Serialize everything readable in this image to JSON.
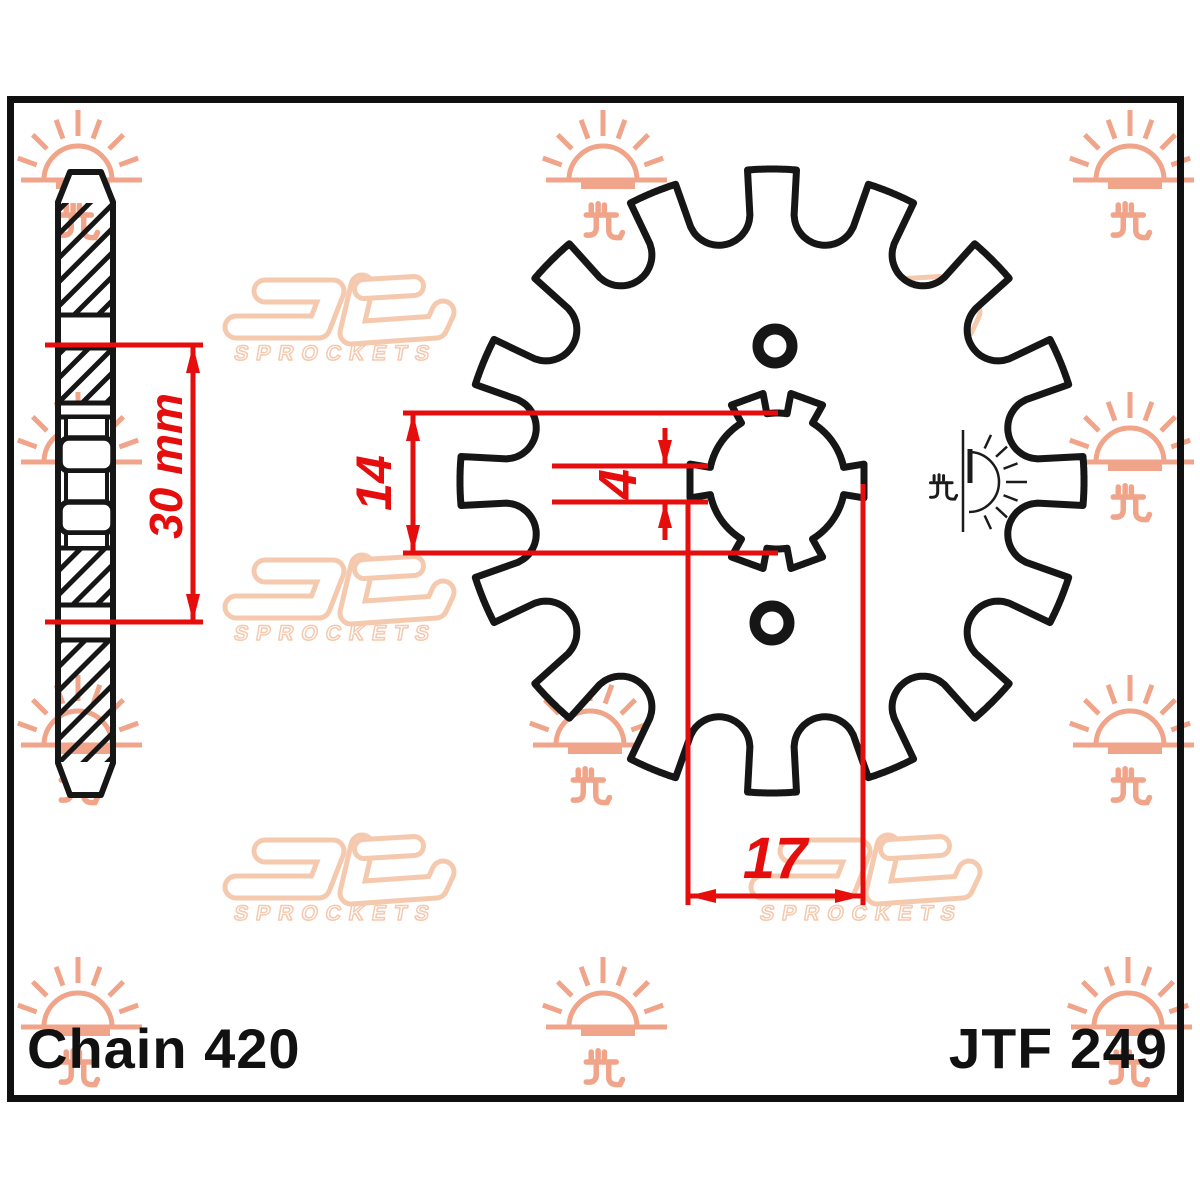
{
  "title": "JT Sprockets front sprocket technical drawing",
  "labels": {
    "chain": "Chain 420",
    "part_number": "JTF 249"
  },
  "dimensions": {
    "hub_width": "30 mm",
    "bore_height": "14",
    "groove_width": "4",
    "bore_width": "17"
  },
  "watermarks": {
    "logo_text": "SPROCKETS",
    "sun_positions": [
      {
        "x": 78,
        "y": 180
      },
      {
        "x": 603,
        "y": 180
      },
      {
        "x": 1130,
        "y": 180
      },
      {
        "x": 78,
        "y": 462
      },
      {
        "x": 603,
        "y": 462
      },
      {
        "x": 1130,
        "y": 462
      },
      {
        "x": 78,
        "y": 745
      },
      {
        "x": 590,
        "y": 745
      },
      {
        "x": 1130,
        "y": 745
      },
      {
        "x": 78,
        "y": 1027
      },
      {
        "x": 603,
        "y": 1027
      },
      {
        "x": 1128,
        "y": 1027
      }
    ],
    "logo_positions": [
      {
        "x": 342,
        "y": 319
      },
      {
        "x": 868,
        "y": 319
      },
      {
        "x": 342,
        "y": 599
      },
      {
        "x": 868,
        "y": 599
      },
      {
        "x": 342,
        "y": 879
      },
      {
        "x": 868,
        "y": 879
      }
    ]
  },
  "drawing": {
    "colors": {
      "line": "#161616",
      "red": "#e60d0d",
      "sun_watermark": "#f0a489",
      "logo_watermark": "#f5c9ae"
    },
    "gear": {
      "cx": 772,
      "cy": 481,
      "teeth": 16,
      "tip_radius": 312,
      "tip_half_deg": 3.6,
      "valley_center_radius": 272,
      "valley_radius": 31,
      "stroke_width": 7
    },
    "bore": {
      "cx": 777,
      "cy": 481,
      "radius": 68,
      "notch_radius": 87,
      "notch_half_deg": 11,
      "notch_angles": [
        0,
        70,
        110,
        180,
        250,
        290
      ],
      "stroke_width": 7
    },
    "holes": [
      {
        "x": 775,
        "y": 346,
        "r": 17,
        "stroke": 11
      },
      {
        "x": 772,
        "y": 623,
        "r": 17,
        "stroke": 11
      }
    ],
    "black_sun_mark": {
      "x": 966,
      "y": 482
    }
  }
}
